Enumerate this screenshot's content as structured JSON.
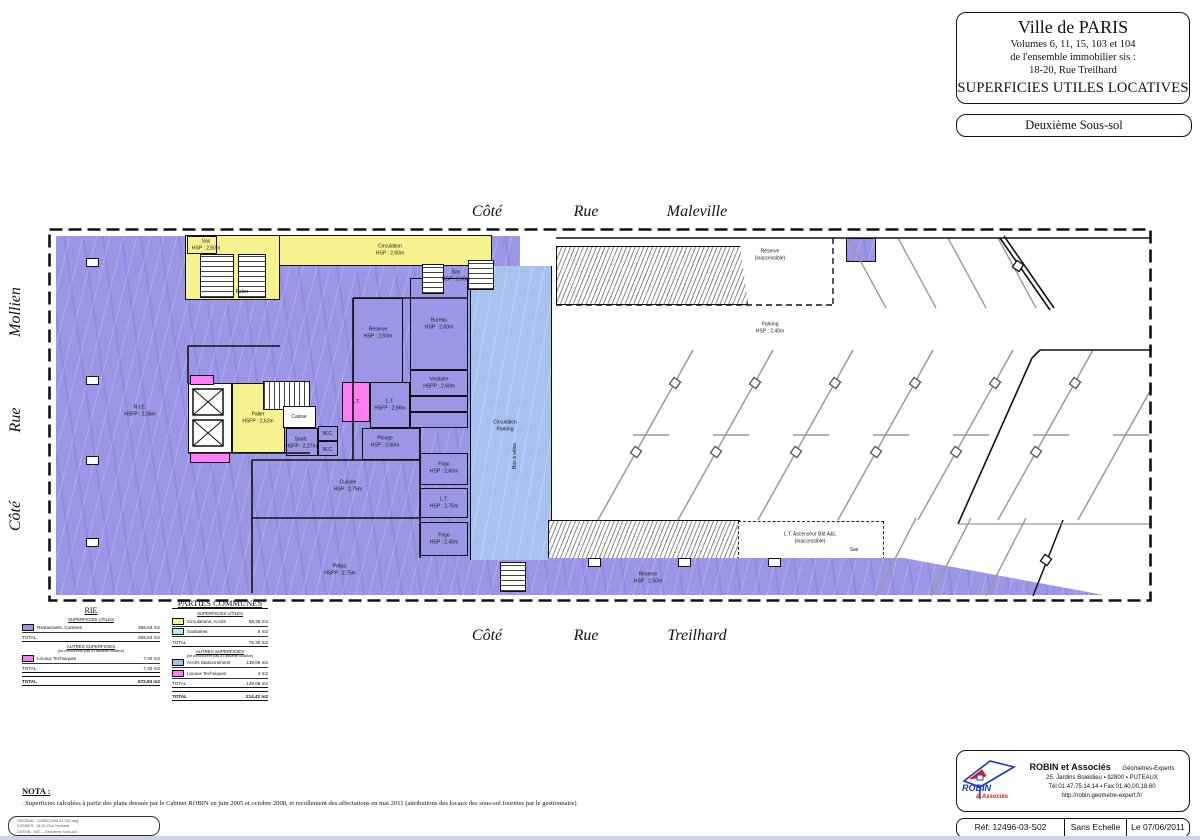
{
  "title_block": {
    "city": "Ville de PARIS",
    "line1": "Volumes 6, 11, 15, 103 et 104",
    "line2": "de l'ensemble immobilier sis :",
    "line3": "18-20, Rue Treilhard",
    "main": "SUPERFICIES UTILES LOCATIVES",
    "level": "Deuxième Sous-sol"
  },
  "streets": {
    "top": {
      "w1": "Côté",
      "w2": "Rue",
      "w3": "Maleville"
    },
    "bottom": {
      "w1": "Côté",
      "w2": "Rue",
      "w3": "Treilhard"
    },
    "left": {
      "w1": "Côté",
      "w2": "Rue",
      "w3": "Mollien"
    }
  },
  "colors": {
    "rie_purple": "#9b96e6",
    "parking_blue": "#a6c1ee",
    "circulation_yellow": "#f6f290",
    "technique_pink": "#fb7ef2",
    "sanitaire_cyan": "#aeeff0"
  },
  "plan": {
    "labels": [
      {
        "t": "Sas\nHSP : 2,50m",
        "x": 158,
        "y": 17
      },
      {
        "t": "Circulation\nHSP : 2,60m",
        "x": 342,
        "y": 22
      },
      {
        "t": "Palier",
        "x": 194,
        "y": 64
      },
      {
        "t": "Sas\nHSP : 2,60m",
        "x": 408,
        "y": 48
      },
      {
        "t": "Réserve\nHSP : 2,60m",
        "x": 330,
        "y": 105
      },
      {
        "t": "Bureau\nHSP : 2,60m",
        "x": 391,
        "y": 96
      },
      {
        "t": "R.I.E.\nHSFP : 2,56m",
        "x": 92,
        "y": 183
      },
      {
        "t": "Palier\nHSFP : 2,62m",
        "x": 210,
        "y": 190
      },
      {
        "t": "Caisse",
        "x": 251,
        "y": 189
      },
      {
        "t": "L.T.",
        "x": 308,
        "y": 174
      },
      {
        "t": "L.T.\nHSFP : 2,56m",
        "x": 342,
        "y": 177
      },
      {
        "t": "Sanit.\nHSFP : 2,27m",
        "x": 253,
        "y": 215
      },
      {
        "t": "W.C.",
        "x": 280,
        "y": 206
      },
      {
        "t": "W.C.",
        "x": 280,
        "y": 222
      },
      {
        "t": "Vestiaire\nHSPP : 2,60m",
        "x": 391,
        "y": 155
      },
      {
        "t": "Plonge\nHSP : 2,60m",
        "x": 337,
        "y": 214
      },
      {
        "t": "Cuisine\nHSP : 2,75m",
        "x": 300,
        "y": 258
      },
      {
        "t": "Frigo\nHSP : 2,60m",
        "x": 396,
        "y": 240
      },
      {
        "t": "L.T.\nHSP : 2,75m",
        "x": 396,
        "y": 275
      },
      {
        "t": "Frigo\nHSP : 2,40m",
        "x": 396,
        "y": 311
      },
      {
        "t": "Prépa.\nHSPP : 2,75m",
        "x": 292,
        "y": 342
      },
      {
        "t": "Circulation\nParking",
        "x": 457,
        "y": 198
      },
      {
        "t": "Box à vélos",
        "x": 467,
        "y": 228,
        "r": 1
      },
      {
        "t": "Réserve\n(inaccessible)",
        "x": 722,
        "y": 27
      },
      {
        "t": "Parking\nHSP : 2,40m",
        "x": 722,
        "y": 100
      },
      {
        "t": "L.T. Ascenseur Bât A&L\n(inaccessible)",
        "x": 762,
        "y": 310
      },
      {
        "t": "Sas",
        "x": 806,
        "y": 322
      },
      {
        "t": "Réserve\nHSP : 2,50m",
        "x": 600,
        "y": 350
      }
    ]
  },
  "legend_rie": {
    "title": "RIE",
    "sections": [
      {
        "header": "SUPERFICIES UTILES",
        "subheader": "",
        "rows": [
          {
            "swatch": "#9b96e6",
            "label": "Restaurants, Cuisines",
            "value": "665,53 m2"
          }
        ],
        "total_label": "TOTAL",
        "total_value": "665,53 m2"
      },
      {
        "header": "AUTRES SUPERFICIES",
        "subheader": "(ne concourent pas à l'assiette locative)",
        "rows": [
          {
            "swatch": "#fb7ef2",
            "label": "Locaux Techniques",
            "value": "7,40 m2"
          }
        ],
        "total_label": "TOTAL",
        "total_value": "7,40 m2"
      }
    ],
    "grand_label": "TOTAL",
    "grand_value": "672,93 m2"
  },
  "legend_pc": {
    "title": "PARTIES COMMUNES",
    "sections": [
      {
        "header": "SUPERFICIES UTILES",
        "subheader": "",
        "rows": [
          {
            "swatch": "#f6f290",
            "label": "Circulations, Accès",
            "value": "69,36 m2"
          },
          {
            "swatch": "#aeeff0",
            "label": "Sanitaires",
            "value": "6 m2"
          }
        ],
        "total_label": "TOTAL",
        "total_value": "75,36 m2"
      },
      {
        "header": "AUTRES SUPERFICIES",
        "subheader": "(ne concourent pas à l'assiette locative)",
        "rows": [
          {
            "swatch": "#a6c1ee",
            "label": "Accès Stationnement",
            "value": "135,06 m2"
          },
          {
            "swatch": "#fb7ef2",
            "label": "Locaux Techniques",
            "value": "4 m2"
          }
        ],
        "total_label": "TOTAL",
        "total_value": "139,06 m2"
      }
    ],
    "grand_label": "TOTAL",
    "grand_value": "214,42 m2"
  },
  "nota": {
    "title": "NOTA :",
    "text": ". Superficies calculées à partir des plans dressés par le Cabinet ROBIN en juin 2005 et octobre 2008, et recollement des affectations en mai 2011 (attributions des locaux des sous-sol fournies par le gestionnaire)",
    "fileinfo_1": "ORIGINAL : 12496\\12496-03-S02.dwg",
    "fileinfo_2": "DOSSIER : 18-20, Rue Treilhard",
    "fileinfo_3": "DESSIN : S02 — Deuxième Sous-sol"
  },
  "footer": {
    "logo_top": "ROBIN",
    "logo_bottom": "& Associés",
    "firm": "ROBIN et Associés",
    "role": "Géomètres-Experts",
    "address": "25, Jardins Boieldieu ▪ 92800 ▪ PUTEAUX",
    "phone": "Tél:01.47.75.14.14 ▪ Fax:01.40.00.18.60",
    "web": "http://robin.geometre-expert.fr/",
    "ref": "Réf: 12496-03-S02",
    "scale": "Sans Echelle",
    "date": "Le 07/06/2011"
  }
}
